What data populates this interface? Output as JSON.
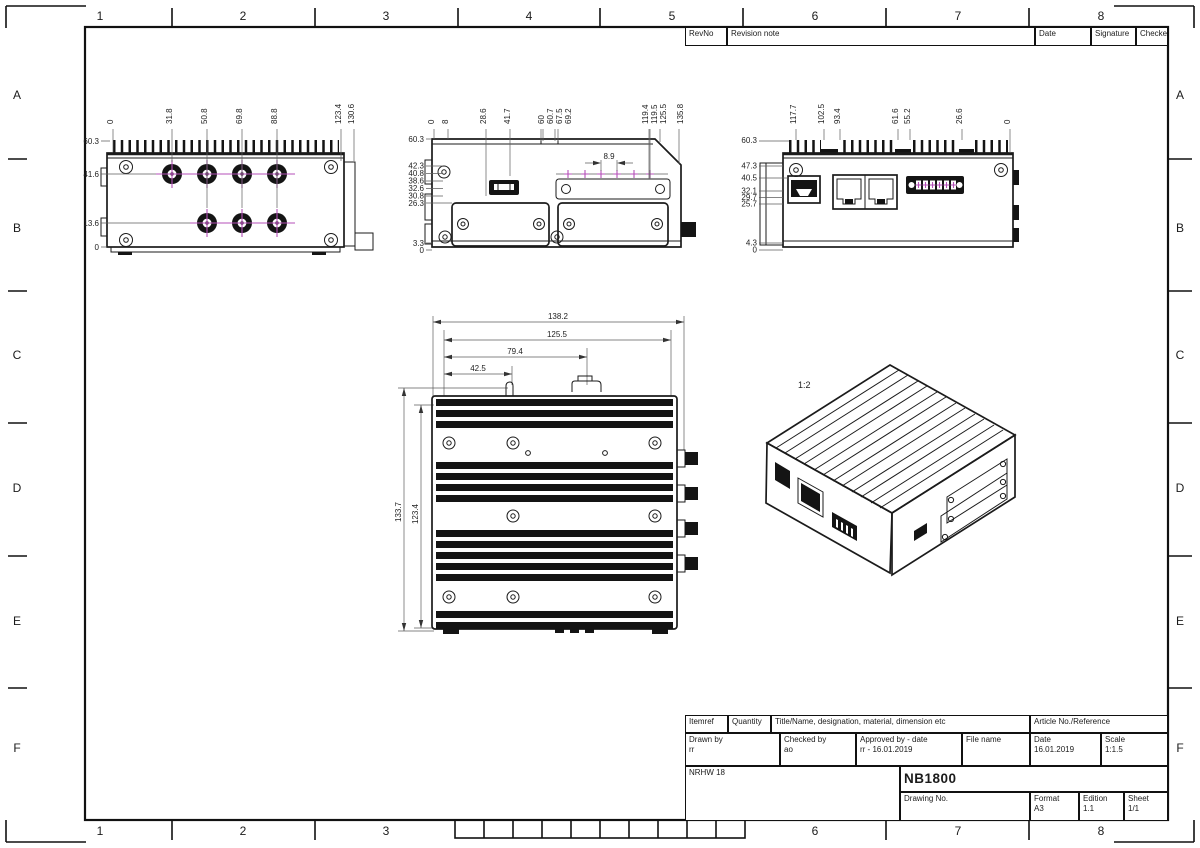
{
  "sheet": {
    "grid_columns_top": [
      "1",
      "2",
      "3",
      "4",
      "5",
      "6",
      "7",
      "8"
    ],
    "grid_columns_bottom": [
      "1",
      "2",
      "3",
      "6",
      "7",
      "8"
    ],
    "grid_rows_left": [
      "A",
      "B",
      "C",
      "D",
      "E",
      "F"
    ],
    "grid_rows_right": [
      "A",
      "B",
      "C",
      "D",
      "E",
      "F"
    ]
  },
  "revision_table": {
    "rev_no": "RevNo",
    "revision_note": "Revision note",
    "date": "Date",
    "signature": "Signature",
    "checked": "Checked"
  },
  "title_block": {
    "itemref_label": "Itemref",
    "quantity_label": "Quantity",
    "title_name_label": "Title/Name, designation, material, dimension etc",
    "article_label": "Article No./Reference",
    "drawn_by_label": "Drawn by",
    "drawn_by_value": "rr",
    "checked_by_label": "Checked by",
    "checked_by_value": "ao",
    "approved_label": "Approved by - date",
    "approved_value": "rr - 16.01.2019",
    "file_name_label": "File name",
    "date_label": "Date",
    "date_value": "16.01.2019",
    "scale_label": "Scale",
    "scale_value": "1:1.5",
    "org": "NRHW 18",
    "product": "NB1800",
    "drawing_no_label": "Drawing No.",
    "format_label": "Format",
    "format_value": "A3",
    "edition_label": "Edition",
    "edition_value": "1.1",
    "sheet_label": "Sheet",
    "sheet_value": "1/1"
  },
  "views": {
    "left_view": {
      "top_dims": [
        "0",
        "31.8",
        "50.8",
        "69.8",
        "88.8",
        "123.4",
        "130.6"
      ],
      "side_dims": [
        "60.3",
        "41.6",
        "13.6",
        "0"
      ]
    },
    "front_view": {
      "top_dims": [
        "0",
        "8",
        "28.6",
        "41.7",
        "60",
        "60.7",
        "67.5",
        "69.2",
        "119.4",
        "119.5",
        "125.5",
        "135.8"
      ],
      "side_dims": [
        "60.3",
        "42.3",
        "40.8",
        "38.6",
        "32.6",
        "30.8",
        "26.3",
        "3.3",
        "0"
      ],
      "detail_dim": "8.9"
    },
    "right_view": {
      "top_dims": [
        "117.7",
        "102.5",
        "93.4",
        "61.6",
        "55.2",
        "26.6",
        "0"
      ],
      "side_dims": [
        "60.3",
        "47.3",
        "40.5",
        "32.1",
        "29.7",
        "25.7",
        "4.3",
        "0"
      ]
    },
    "top_view": {
      "width_dims": [
        "138.2",
        "125.5",
        "79.4",
        "42.5"
      ],
      "height_dims": [
        "133.7",
        "123.4"
      ]
    },
    "iso_view": {
      "scale_label": "1:2"
    }
  },
  "colors": {
    "centerline": "#b44fb8",
    "line": "#1b1b1b",
    "thin_line": "#5d5d5d"
  }
}
